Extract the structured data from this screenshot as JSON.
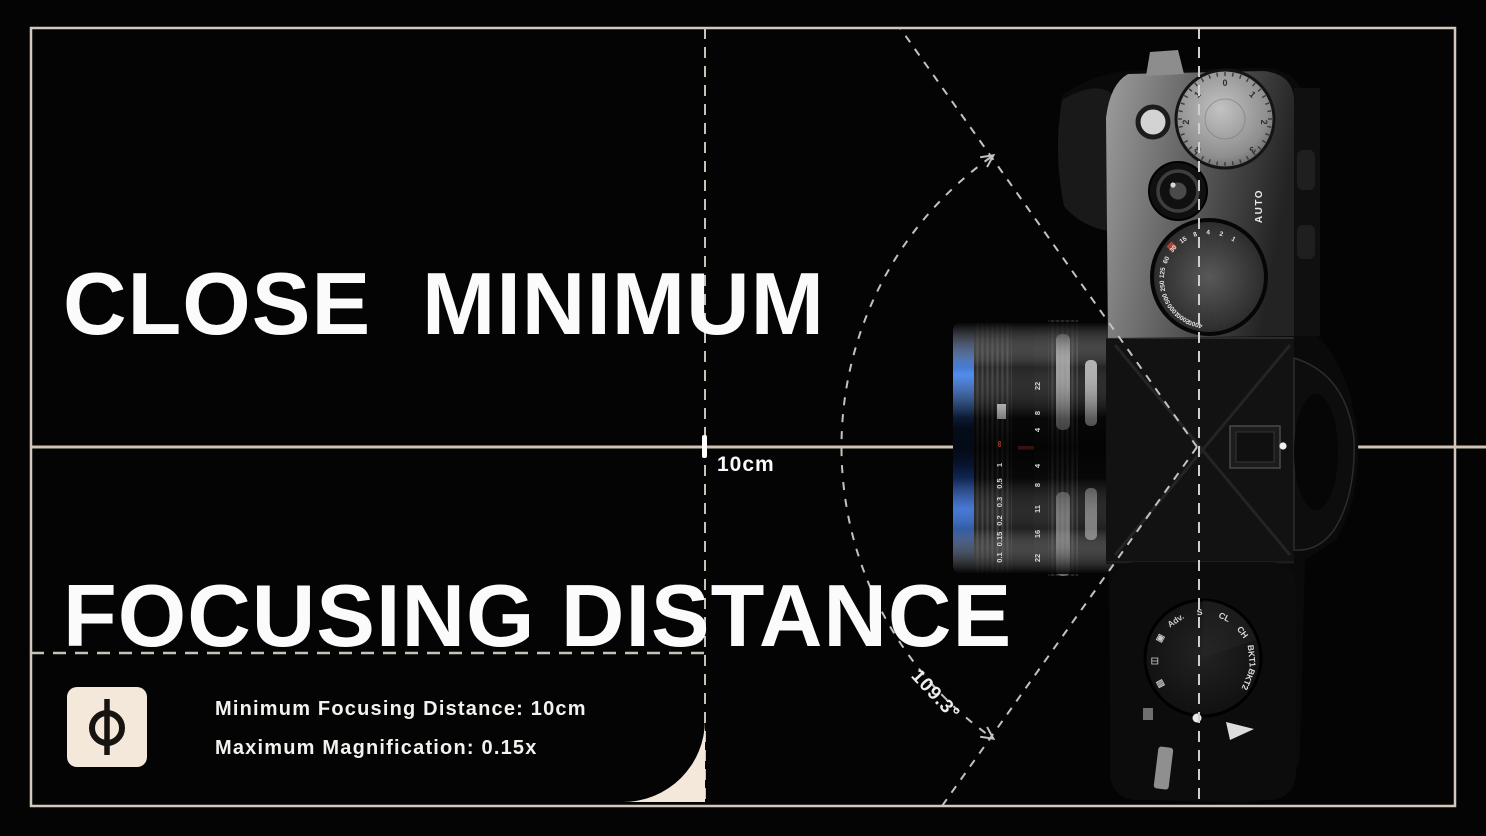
{
  "header": {
    "title_line1": "CLOSE  MINIMUM",
    "title_line2": "FOCUSING DISTANCE"
  },
  "diagram": {
    "distance_label": "10cm",
    "angle_label": "109.3°"
  },
  "footer": {
    "spec_line1": "Minimum Focusing Distance: 10cm",
    "spec_line2": "Maximum Magnification: 0.15x",
    "icon_symbol": "focal-plane-mark"
  },
  "camera": {
    "auto_label": "AUTO",
    "shutter_dial_speeds": [
      "4000",
      "2000",
      "1000",
      "500",
      "250",
      "125",
      "60",
      "30",
      "15",
      "8",
      "4",
      "2",
      "1"
    ],
    "exposure_dial_marks": [
      "3",
      "2",
      "1",
      "0",
      "1",
      "2",
      "3"
    ],
    "drive_dial_labels_right": [
      "S",
      "CL",
      "CH",
      "BKT1",
      "BKT2"
    ],
    "drive_dial_labels_left": [
      "Adv.",
      "▣",
      "◫",
      "▤"
    ],
    "lens_infinity_mark": "∞",
    "lens_distance_scale": [
      "1",
      "0.5",
      "0.3",
      "0.2",
      "0.15",
      "0.1"
    ],
    "lens_aperture_scale_upper": [
      "4",
      "8",
      "22"
    ],
    "lens_aperture_scale_lower": [
      "4",
      "8",
      "11",
      "16",
      "22"
    ]
  },
  "colors": {
    "accent_cream": "#f3e8d9",
    "line_cream": "#d3c9ba",
    "dash_gray": "#c6c2b8",
    "lens_blue": "#2f6fe4",
    "marking_red": "#b5402f",
    "text_white": "#fbfbfb"
  }
}
